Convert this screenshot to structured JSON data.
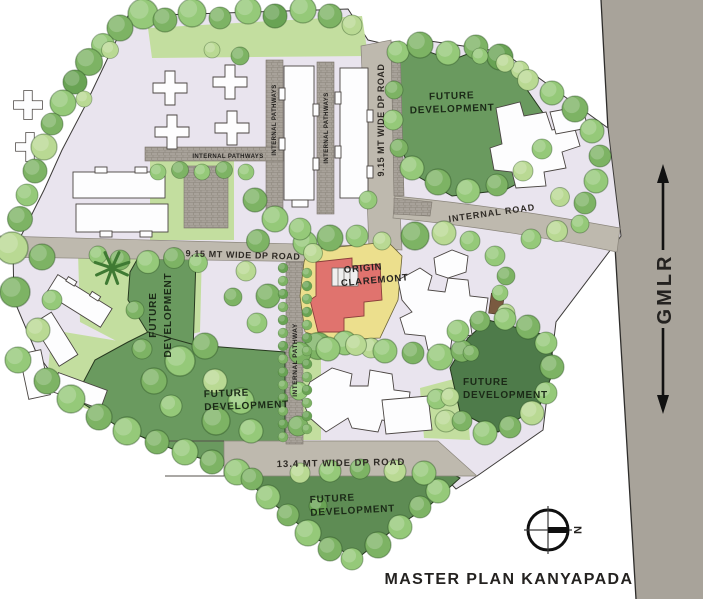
{
  "title": "MASTER PLAN KANYAPADA",
  "compass": {
    "north": "N"
  },
  "roads": {
    "gmlr": "GMLR",
    "dp_915": "9.15 MT WIDE DP ROAD",
    "dp_134": "13.4 MT WIDE DP ROAD",
    "internal": "INTERNAL ROAD",
    "pathways": "INTERNAL PATHWAYS",
    "pathway": "INTERNAL PATHWAY"
  },
  "parcels": {
    "future": {
      "l1": "FUTURE",
      "l2": "DEVELOPMENT"
    },
    "origin": {
      "l1": "ORIGIN",
      "l2": "CLAREMONT"
    }
  },
  "colors": {
    "page": "#ffffff",
    "site": "#e9e4ee",
    "gmlr": "#a8a39a",
    "road": "#beb9ae",
    "pathway": "#a8a29a",
    "lawn": "#c3de9f",
    "green_a": "#6a9a5f",
    "green_b": "#4e7b4a",
    "green_c": "#5e8c54",
    "yellow": "#ecdf8d",
    "red": "#e0736e",
    "building": "#fdfdfe",
    "outline": "#4a4542",
    "tree_1": "#7db364",
    "tree_2": "#95c979",
    "tree_3": "#69a354",
    "tree_4": "#b9d993"
  }
}
